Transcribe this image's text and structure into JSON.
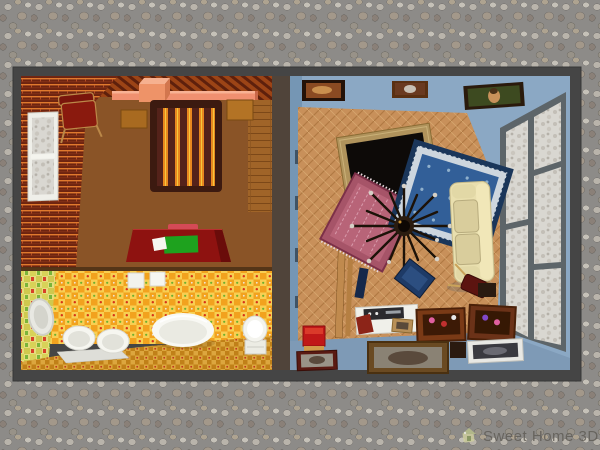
{
  "watermark": {
    "text": "Sweet Home 3D"
  },
  "scene": {
    "view": "aerial-3d-render-of-furnished-apartment",
    "ground_texture": "gray cobblestone pebbles",
    "colors": {
      "ground": "#8d8b88",
      "wall_cap": "#454545",
      "brick_wall": "#6e2410",
      "brick_mortar": "#e07a2e",
      "bedroom_floor": "#8a5427",
      "bathroom_tile_wall": "#f8cf52",
      "bathroom_tile_accent": "#f2a21e",
      "living_room_wall": "#8ba8c4",
      "parquet_floor": "#c8905a",
      "bed_blanket": "#54221a",
      "bed_stripe_orange": "#e8871f",
      "bed_stripe_yellow": "#f5c83c",
      "desk_red": "#8e1210",
      "desk_pad_green": "#1ea21e",
      "sofa_cream": "#e9dfae",
      "rug_blue": "#325f98",
      "rug_red": "#a65468",
      "shelf_salmon": "#f09070",
      "window_frame_gray": "#5d6569",
      "watermark_text": "#5f5b55"
    },
    "rooms": [
      {
        "name": "bedroom",
        "walls": "red brick",
        "floor": "brown",
        "items": [
          "frosted window",
          "salmon wall shelf",
          "salmon storage box",
          "red chair",
          "double bed with striped blanket",
          "left nightstand",
          "right nightstand",
          "plank wardrobe",
          "red writing desk",
          "green desk pad",
          "paper sheet",
          "crimson tray"
        ]
      },
      {
        "name": "bathroom",
        "walls": "yellow-orange checker tile",
        "floor": "orange checker tile",
        "items": [
          "oval mirror",
          "hanging towels",
          "two basins",
          "bench shelf",
          "oval bathtub",
          "toilet"
        ]
      },
      {
        "name": "living-room",
        "walls": "light blue",
        "floor": "herringbone parquet",
        "items": [
          "painting 1",
          "painting 2",
          "mona lisa painting",
          "large paned window",
          "gilt picture frame",
          "blue persian rug",
          "red persian rug",
          "sputnik chandelier",
          "cream sofa",
          "door panel",
          "red stool",
          "stereo tray",
          "blue books",
          "fallen chair",
          "wooden crate 1",
          "wooden crate 2",
          "leaning paintings"
        ]
      }
    ]
  }
}
